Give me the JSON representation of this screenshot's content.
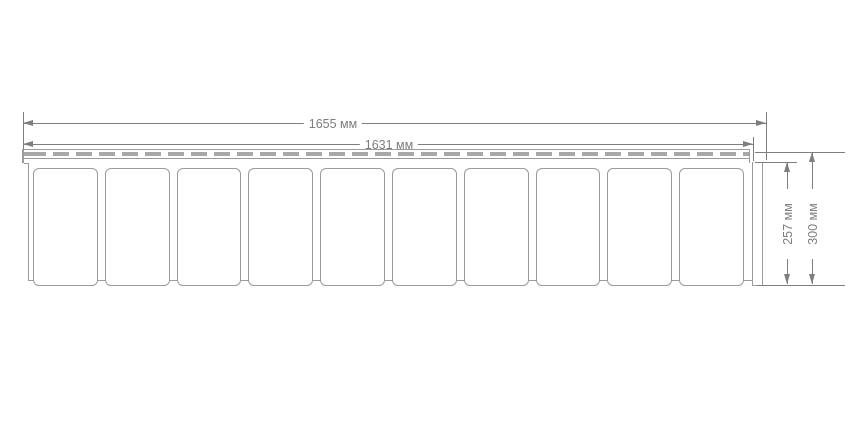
{
  "drawing": {
    "type": "technical-panel-drawing",
    "dimensions": {
      "total_length": {
        "label": "1655 мм"
      },
      "inner_length": {
        "label": "1631 мм"
      },
      "inner_height": {
        "label": "257 мм"
      },
      "total_height": {
        "label": "300 мм"
      }
    },
    "panel": {
      "tile_count": 10
    },
    "colors": {
      "dimension_line": "#7e7e7e",
      "label_text": "#7e7e7e",
      "panel_outline": "#9b9b9b",
      "perforation_fill": "#a8a8a8",
      "background": "#ffffff"
    }
  }
}
